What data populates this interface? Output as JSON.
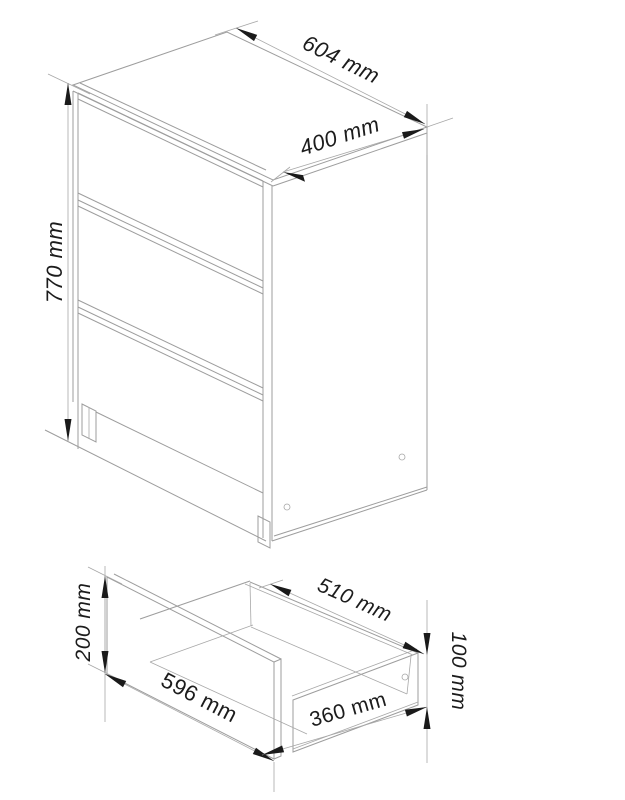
{
  "drawing": {
    "unit": "mm",
    "colors": {
      "line": "#9d9d9d",
      "ink": "#1c1c1c",
      "background": "#ffffff"
    },
    "dresser_view": {
      "drawer_count": 3,
      "dims": {
        "width": {
          "value": 604,
          "label": "604 mm"
        },
        "depth": {
          "value": 400,
          "label": "400 mm"
        },
        "height": {
          "value": 770,
          "label": "770 mm"
        }
      }
    },
    "drawer_view": {
      "dims": {
        "front_height": {
          "value": 200,
          "label": "200 mm"
        },
        "front_width": {
          "value": 596,
          "label": "596 mm"
        },
        "inner_length": {
          "value": 510,
          "label": "510 mm"
        },
        "side_length": {
          "value": 360,
          "label": "360 mm"
        },
        "side_height": {
          "value": 100,
          "label": "100 mm"
        }
      }
    }
  }
}
